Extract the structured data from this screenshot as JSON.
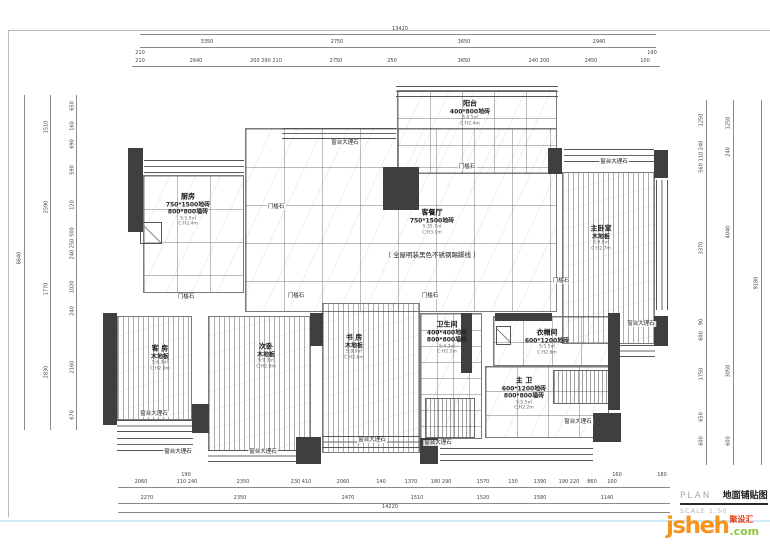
{
  "title_block": {
    "plan_label": "PLAN",
    "drawing_name": "地面铺贴图",
    "scale_label": "SCALE 1:50"
  },
  "logo": {
    "brand": "jsheh",
    "badge": "聚设汇",
    "tld": ".com"
  },
  "colors": {
    "wall": "#3f3f3f",
    "logo_orange": "#f7941d",
    "logo_green": "#8dc63f",
    "logo_red": "#e8380d",
    "bottom_line": "#cfe9f5"
  },
  "note": {
    "t": "（ 全屋明装黑色不锈钢踢脚线 ）",
    "x": 432,
    "y": 249
  },
  "rooms": [
    {
      "id": "balcony",
      "name": "阳台",
      "specs": [
        "400*800地砖"
      ],
      "subs": [
        "S:4.5㎡",
        "C:H2.4m"
      ],
      "x": 470,
      "y": 113
    },
    {
      "id": "kitchen",
      "name": "厨房",
      "specs": [
        "750*1500地砖",
        "800*800墙砖"
      ],
      "subs": [
        "S:5.9㎡",
        "C:H2.4m"
      ],
      "x": 188,
      "y": 210
    },
    {
      "id": "living-dining",
      "name": "客餐厅",
      "specs": [
        "750*1500地砖"
      ],
      "subs": [
        "S:35.7㎡",
        "C:H3.1m"
      ],
      "x": 432,
      "y": 222
    },
    {
      "id": "master-bedroom",
      "name": "主卧室",
      "specs": [
        "木地板"
      ],
      "subs": [
        "S:9.8㎡",
        "C:H2.7m"
      ],
      "x": 601,
      "y": 238
    },
    {
      "id": "guest-room",
      "name": "客 房",
      "specs": [
        "木地板"
      ],
      "subs": [
        "S:6.3㎡",
        "C:H2.8m"
      ],
      "x": 160,
      "y": 358
    },
    {
      "id": "second-bedroom",
      "name": "次卧",
      "specs": [
        "木地板"
      ],
      "subs": [
        "S:9.3㎡",
        "C:H2.8m"
      ],
      "x": 266,
      "y": 356
    },
    {
      "id": "study",
      "name": "书 房",
      "specs": [
        "木地板"
      ],
      "subs": [
        "S:9.0㎡",
        "C:H2.8m"
      ],
      "x": 354,
      "y": 347
    },
    {
      "id": "bathroom",
      "name": "卫生间",
      "specs": [
        "400*400地砖",
        "800*800墙砖"
      ],
      "subs": [
        "S:4.3㎡",
        "C:H2.2m"
      ],
      "x": 447,
      "y": 338
    },
    {
      "id": "cloakroom",
      "name": "衣帽间",
      "specs": [
        "600*1200地砖"
      ],
      "subs": [
        "S:5.5㎡",
        "C:H2.8m"
      ],
      "x": 547,
      "y": 342
    },
    {
      "id": "master-bath",
      "name": "主 卫",
      "specs": [
        "600*1200地砖",
        "800*800墙砖"
      ],
      "subs": [
        "S:5.5㎡",
        "C:H2.2m"
      ],
      "x": 524,
      "y": 394
    }
  ],
  "stones": [
    {
      "t": "窗台大理石",
      "x": 345,
      "y": 143
    },
    {
      "t": "窗台大理石",
      "x": 614,
      "y": 162
    },
    {
      "t": "窗台大理石",
      "x": 641,
      "y": 324
    },
    {
      "t": "窗台大理石",
      "x": 154,
      "y": 414
    },
    {
      "t": "窗台大理石",
      "x": 178,
      "y": 452
    },
    {
      "t": "窗台大理石",
      "x": 263,
      "y": 452
    },
    {
      "t": "窗台大理石",
      "x": 372,
      "y": 440
    },
    {
      "t": "窗台大理石",
      "x": 438,
      "y": 443
    },
    {
      "t": "窗台大理石",
      "x": 578,
      "y": 422
    },
    {
      "t": "门槛石",
      "x": 276,
      "y": 207
    },
    {
      "t": "门槛石",
      "x": 467,
      "y": 167
    },
    {
      "t": "门槛石",
      "x": 186,
      "y": 297
    },
    {
      "t": "门槛石",
      "x": 296,
      "y": 296
    },
    {
      "t": "门槛石",
      "x": 430,
      "y": 296
    },
    {
      "t": "门槛石",
      "x": 561,
      "y": 281
    }
  ],
  "dims": {
    "top": [
      {
        "t": "13420",
        "x": 400,
        "y": 27
      },
      {
        "t": "3350",
        "x": 207,
        "y": 40
      },
      {
        "t": "2750",
        "x": 337,
        "y": 40
      },
      {
        "t": "3650",
        "x": 464,
        "y": 40
      },
      {
        "t": "2940",
        "x": 599,
        "y": 40
      },
      {
        "t": "210",
        "x": 140,
        "y": 51
      },
      {
        "t": "210",
        "x": 140,
        "y": 59
      },
      {
        "t": "2640",
        "x": 196,
        "y": 59
      },
      {
        "t": "200 290 210",
        "x": 266,
        "y": 59
      },
      {
        "t": "2750",
        "x": 336,
        "y": 59
      },
      {
        "t": "250",
        "x": 392,
        "y": 59
      },
      {
        "t": "3650",
        "x": 464,
        "y": 59
      },
      {
        "t": "240 200",
        "x": 539,
        "y": 59
      },
      {
        "t": "2450",
        "x": 591,
        "y": 59
      },
      {
        "t": "190",
        "x": 652,
        "y": 51
      },
      {
        "t": "100",
        "x": 645,
        "y": 59
      }
    ],
    "bottom": [
      {
        "t": "190",
        "x": 186,
        "y": 473
      },
      {
        "t": "2060",
        "x": 141,
        "y": 480
      },
      {
        "t": "110 240",
        "x": 187,
        "y": 480
      },
      {
        "t": "2350",
        "x": 243,
        "y": 480
      },
      {
        "t": "230 410",
        "x": 301,
        "y": 480
      },
      {
        "t": "2060",
        "x": 343,
        "y": 480
      },
      {
        "t": "140",
        "x": 381,
        "y": 480
      },
      {
        "t": "1370",
        "x": 411,
        "y": 480
      },
      {
        "t": "180 290",
        "x": 441,
        "y": 480
      },
      {
        "t": "1570",
        "x": 483,
        "y": 480
      },
      {
        "t": "130",
        "x": 513,
        "y": 480
      },
      {
        "t": "1390",
        "x": 540,
        "y": 480
      },
      {
        "t": "190 220",
        "x": 569,
        "y": 480
      },
      {
        "t": "860",
        "x": 592,
        "y": 480
      },
      {
        "t": "160",
        "x": 617,
        "y": 473
      },
      {
        "t": "100",
        "x": 612,
        "y": 480
      },
      {
        "t": "180",
        "x": 662,
        "y": 473
      },
      {
        "t": "2270",
        "x": 147,
        "y": 496
      },
      {
        "t": "2350",
        "x": 240,
        "y": 496
      },
      {
        "t": "2470",
        "x": 348,
        "y": 496
      },
      {
        "t": "1510",
        "x": 417,
        "y": 496
      },
      {
        "t": "1520",
        "x": 483,
        "y": 496
      },
      {
        "t": "1580",
        "x": 540,
        "y": 496
      },
      {
        "t": "1140",
        "x": 607,
        "y": 496
      },
      {
        "t": "14220",
        "x": 390,
        "y": 505
      }
    ],
    "left": [
      {
        "t": "8640",
        "x": 20,
        "y": 258
      },
      {
        "t": "1510",
        "x": 47,
        "y": 127
      },
      {
        "t": "2590",
        "x": 47,
        "y": 207
      },
      {
        "t": "1770",
        "x": 47,
        "y": 289
      },
      {
        "t": "2830",
        "x": 47,
        "y": 372
      },
      {
        "t": "650",
        "x": 73,
        "y": 106
      },
      {
        "t": "160",
        "x": 73,
        "y": 126
      },
      {
        "t": "690",
        "x": 73,
        "y": 144
      },
      {
        "t": "590",
        "x": 73,
        "y": 170
      },
      {
        "t": "120",
        "x": 73,
        "y": 205
      },
      {
        "t": "500",
        "x": 73,
        "y": 232
      },
      {
        "t": "240 250",
        "x": 73,
        "y": 249
      },
      {
        "t": "1020",
        "x": 73,
        "y": 287
      },
      {
        "t": "240",
        "x": 73,
        "y": 311
      },
      {
        "t": "2160",
        "x": 73,
        "y": 367
      },
      {
        "t": "670",
        "x": 73,
        "y": 415
      }
    ],
    "right": [
      {
        "t": "9180",
        "x": 757,
        "y": 283
      },
      {
        "t": "1250",
        "x": 729,
        "y": 123
      },
      {
        "t": "240",
        "x": 729,
        "y": 152
      },
      {
        "t": "4040",
        "x": 729,
        "y": 232
      },
      {
        "t": "3050",
        "x": 729,
        "y": 371
      },
      {
        "t": "600",
        "x": 729,
        "y": 441
      },
      {
        "t": "1250",
        "x": 702,
        "y": 120
      },
      {
        "t": "110 240",
        "x": 702,
        "y": 151
      },
      {
        "t": "560",
        "x": 702,
        "y": 168
      },
      {
        "t": "3370",
        "x": 702,
        "y": 248
      },
      {
        "t": "90",
        "x": 702,
        "y": 322
      },
      {
        "t": "600",
        "x": 702,
        "y": 336
      },
      {
        "t": "1750",
        "x": 702,
        "y": 374
      },
      {
        "t": "650",
        "x": 702,
        "y": 417
      },
      {
        "t": "600",
        "x": 702,
        "y": 441
      }
    ]
  }
}
